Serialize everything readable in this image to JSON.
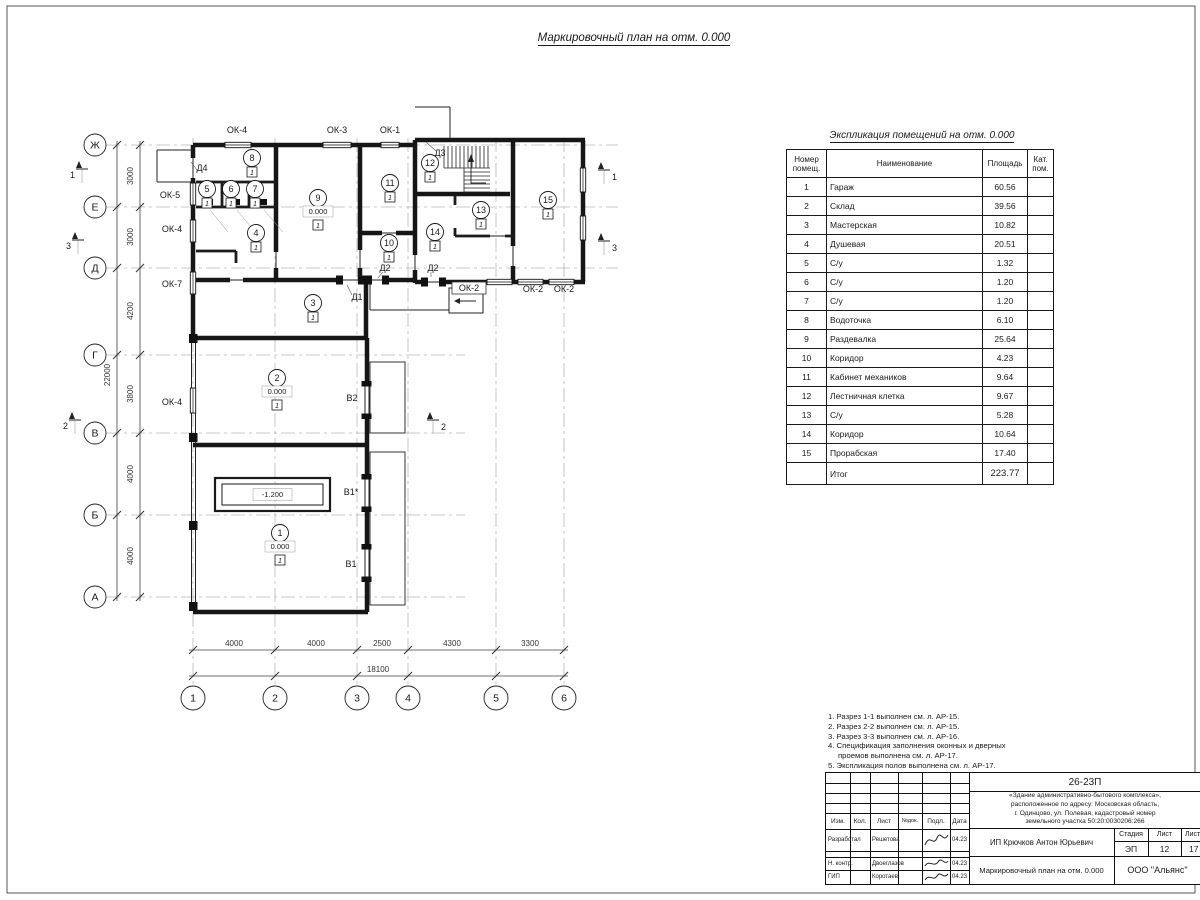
{
  "sheet": {
    "plan_title": "Маркировочный план на отм. 0.000",
    "table_title": "Экспликация помещений на отм. 0.000"
  },
  "rooms_table": {
    "col_num": "Номер помещ.",
    "col_name": "Наименование",
    "col_area": "Площадь",
    "col_cat": "Кат. пом.",
    "rows": [
      {
        "num": "1",
        "name": "Гараж",
        "area": "60.56"
      },
      {
        "num": "2",
        "name": "Склад",
        "area": "39.56"
      },
      {
        "num": "3",
        "name": "Мастерская",
        "area": "10.82"
      },
      {
        "num": "4",
        "name": "Душевая",
        "area": "20.51"
      },
      {
        "num": "5",
        "name": "С/у",
        "area": "1.32"
      },
      {
        "num": "6",
        "name": "С/у",
        "area": "1.20"
      },
      {
        "num": "7",
        "name": "С/у",
        "area": "1.20"
      },
      {
        "num": "8",
        "name": "Водоточка",
        "area": "6.10"
      },
      {
        "num": "9",
        "name": "Раздевалка",
        "area": "25.64"
      },
      {
        "num": "10",
        "name": "Коридор",
        "area": "4.23"
      },
      {
        "num": "11",
        "name": "Кабинет механиков",
        "area": "9.64"
      },
      {
        "num": "12",
        "name": "Лестничная клетка",
        "area": "9.67"
      },
      {
        "num": "13",
        "name": "С/у",
        "area": "5.28"
      },
      {
        "num": "14",
        "name": "Коридор",
        "area": "10.64"
      },
      {
        "num": "15",
        "name": "Прорабская",
        "area": "17.40"
      }
    ],
    "total_label": "Итог",
    "total_area": "223.77"
  },
  "notes": {
    "line1": "1. Разрез 1-1 выполнен см. л. АР-15.",
    "line2": "2. Разрез 2-2 выполнен см. л. АР-15.",
    "line3": "3. Разрез 3-3 выполнен см. л. АР-16.",
    "line4": "4. Спецификация заполнения оконных и дверных",
    "line5": "проемов выполнена см. л. АР-17.",
    "line6": "5. Экспликация полов выполнена см. л. АР-17."
  },
  "title_block": {
    "doc_number": "26-23П",
    "project_line1": "«Здание административно-бытового комплекса»,",
    "project_line2": "расположенное по адресу: Московская область,",
    "project_line3": "г. Одинцово, ул. Полевая, кадастровый номер",
    "project_line4": "земельного участка 50:20:0030206:266",
    "col_izm": "Изм.",
    "col_kol": "Кол.",
    "col_list": "Лист",
    "col_ndok": "№док.",
    "col_podl": "Подл.",
    "col_data": "Дата",
    "row1_role": "Разработал",
    "row1_name": "Решетова",
    "row1_date": "04.23",
    "row2_role": "Н. контр.",
    "row2_name": "Двоеглазов",
    "row2_date": "04.23",
    "row3_role": "ГИП",
    "row3_name": "Коротаев",
    "row3_date": "04.23",
    "client": "ИП Крючков Антон Юрьевич",
    "stage_label": "Стадия",
    "sheet_label": "Лист",
    "sheets_label": "Листов",
    "stage_value": "ЭП",
    "sheet_value": "12",
    "sheets_value": "17",
    "drawing_title": "Маркировочный план на отм. 0.000",
    "company": "ООО \"Альянс\""
  },
  "plan": {
    "row_axes": [
      "Ж",
      "Е",
      "Д",
      "Г",
      "В",
      "Б",
      "А"
    ],
    "col_axes": [
      "1",
      "2",
      "3",
      "4",
      "5",
      "6"
    ],
    "left_dims": [
      "3000",
      "3000",
      "4200",
      "3800",
      "4000",
      "4000"
    ],
    "left_total": "22000",
    "bottom_dims": [
      "4000",
      "4000",
      "2500",
      "4300",
      "3300"
    ],
    "bottom_total": "18100",
    "windows": {
      "top1": "ОК-4",
      "top2": "ОК-3",
      "top3": "ОК-1",
      "left1": "ОК-5",
      "left2": "ОК-4",
      "left3": "ОК-7",
      "left4": "ОК-4",
      "bot1": "ОК-2",
      "bot2": "ОК-2",
      "bot3": "ОК-2"
    },
    "doors": {
      "d1": "Д1",
      "d2a": "Д2",
      "d2b": "Д2",
      "d3": "Д3",
      "d4": "Д4"
    },
    "gates": {
      "v2": "В2",
      "v1s": "В1*",
      "v1": "В1"
    },
    "sections": {
      "s1": "1",
      "s2": "2",
      "s3": "3"
    },
    "rooms": [
      {
        "num": "1",
        "elev": "0.000"
      },
      {
        "num": "2",
        "elev": "0.000"
      },
      {
        "num": "3"
      },
      {
        "num": "4"
      },
      {
        "num": "5"
      },
      {
        "num": "6"
      },
      {
        "num": "7"
      },
      {
        "num": "8"
      },
      {
        "num": "9",
        "elev": "0.000"
      },
      {
        "num": "10"
      },
      {
        "num": "11"
      },
      {
        "num": "12"
      },
      {
        "num": "13"
      },
      {
        "num": "14"
      },
      {
        "num": "15"
      }
    ],
    "pit_elev": "-1.200",
    "floor_mark": "1"
  }
}
